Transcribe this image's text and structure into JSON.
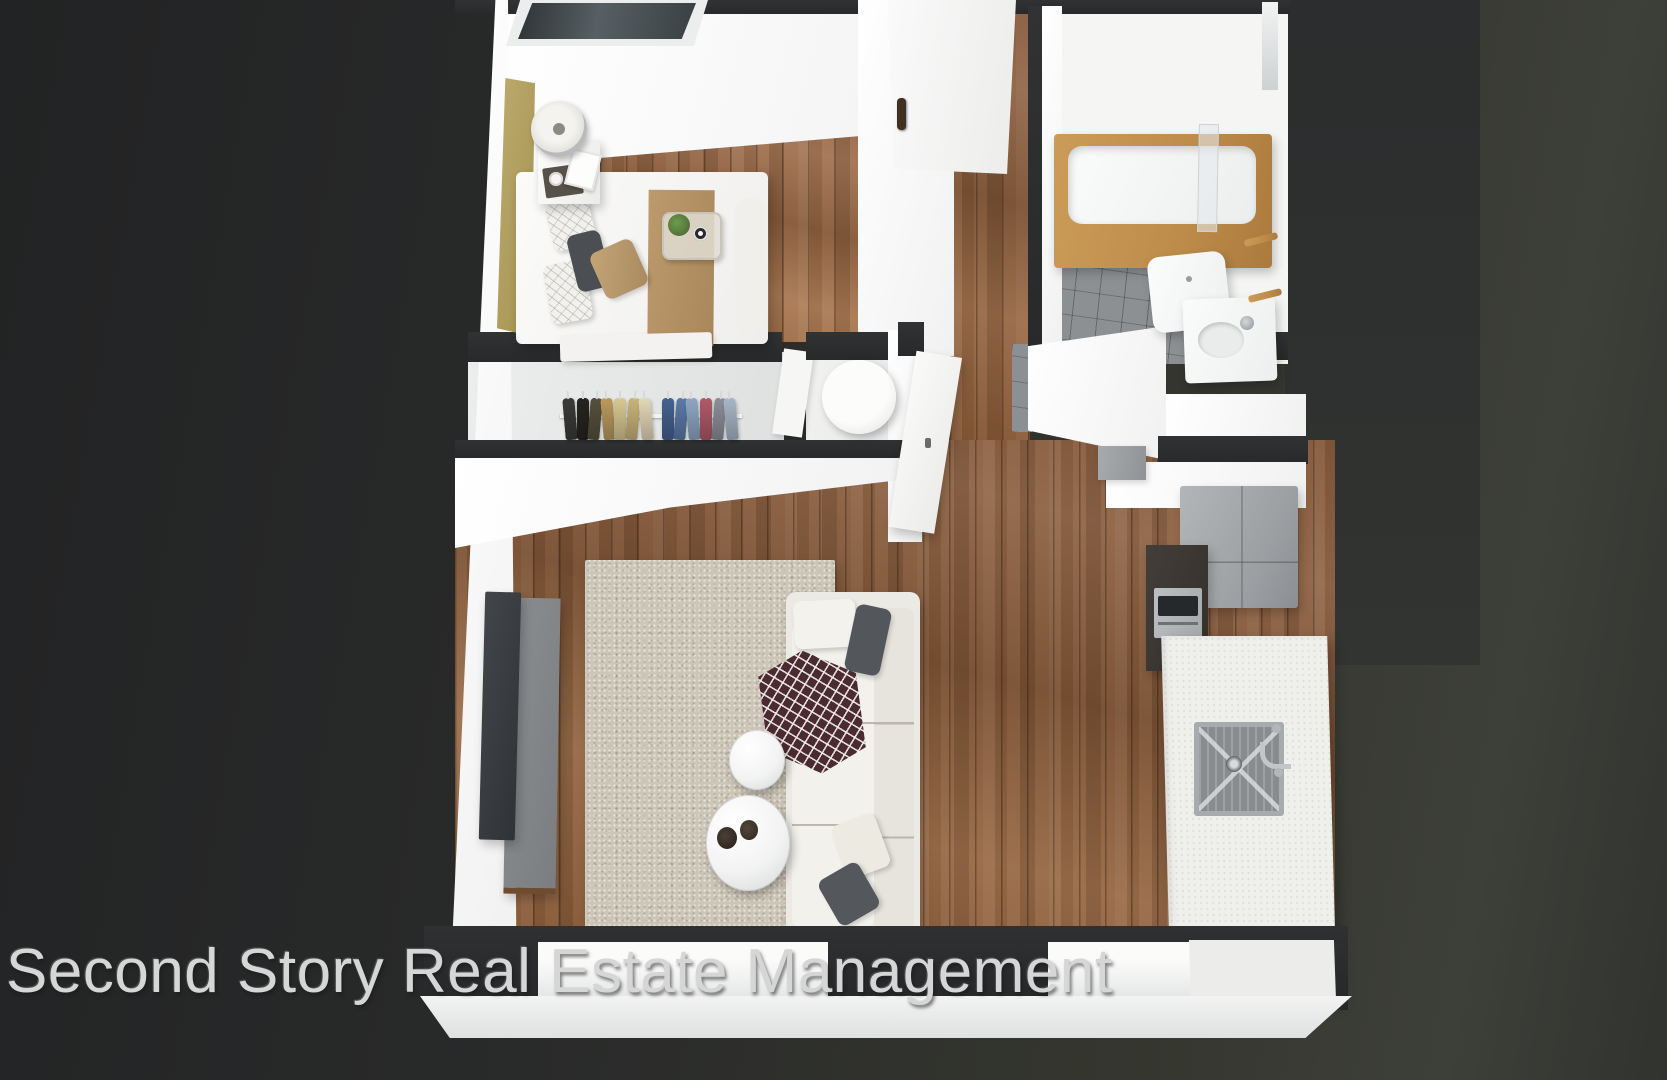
{
  "watermark": {
    "text": "Second Story Real Estate Management"
  },
  "scene": {
    "type": "3d-floor-plan-render",
    "description": "Top-down 3D rendering of a one-bedroom apartment unit on a dark charcoal background",
    "rooms": [
      "bedroom",
      "bathroom",
      "closet",
      "utility-closet",
      "entry-hall",
      "living-room",
      "kitchen"
    ],
    "furniture": [
      "bed",
      "headboard",
      "nightstand",
      "table-lamp",
      "breakfast-tray",
      "clothes-rack",
      "water-heater",
      "tv",
      "tv-console",
      "area-rug",
      "sofa",
      "throw-blanket",
      "round-coffee-table-large",
      "round-coffee-table-small",
      "refrigerator",
      "oven-cabinet",
      "range-hood",
      "kitchen-counter",
      "kitchen-sink",
      "bathtub",
      "shower-screen",
      "toilet",
      "bathroom-vanity",
      "towel-bars"
    ],
    "closet_clothes_colors": [
      "#3a3a38",
      "#26241f",
      "#55503e",
      "#b99a5e",
      "#d8c892",
      "#c9b47a",
      "#e2d7b8",
      "#46628f",
      "#5b7aa8",
      "#8fa6c4",
      "#b05a6a",
      "#8b8f98",
      "#a8b6c8"
    ]
  },
  "palette": {
    "background": "#2c2d2c",
    "wall_top": "#2b2d2f",
    "wall_face": "#f7f7f6",
    "floor_wood": "#8a5e3e",
    "tile": "#8d9092",
    "rug": "#cdc5b7",
    "oak_accent": "#c2914f",
    "headboard_gold": "#b3a266",
    "sofa_cream": "#eceae4",
    "counter_white": "#efefec",
    "fridge_gray": "#a8acaf",
    "cabinet_dark": "#3b3733",
    "tv_dark": "#393c3f",
    "console_gray": "#85888b",
    "watermark": "#d6d6d6"
  }
}
